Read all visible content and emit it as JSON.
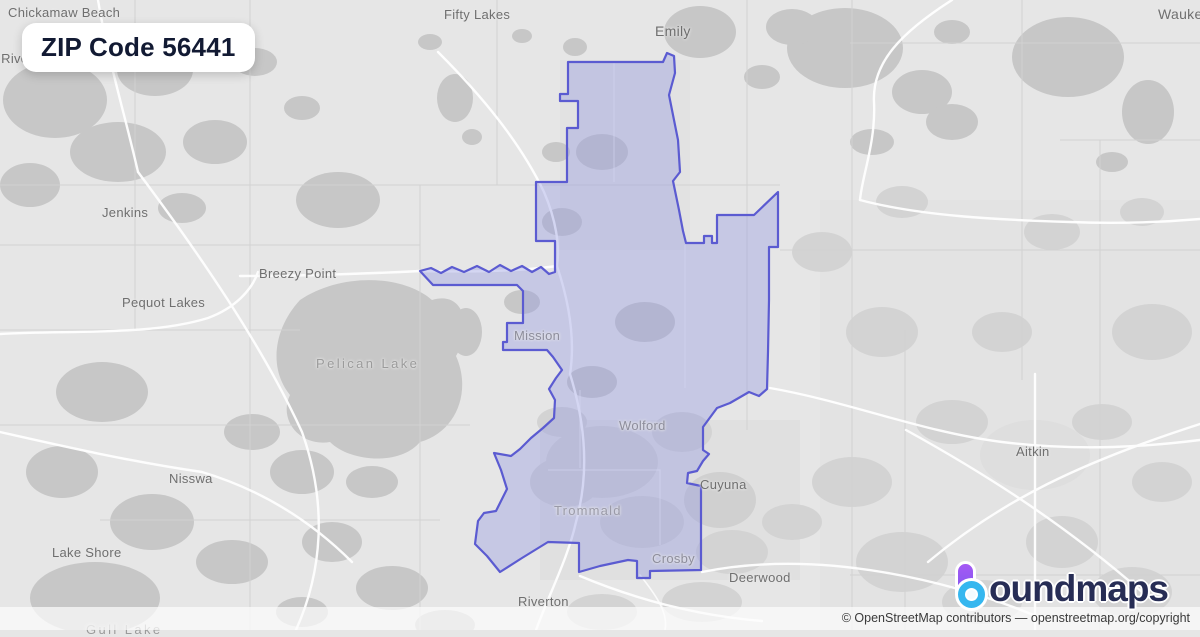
{
  "title": {
    "text": "ZIP Code 56441"
  },
  "map": {
    "region": {
      "name": "ZIP 56441 boundary",
      "fill": "rgba(150,156,226,0.40)",
      "stroke": "#5b5bd1"
    },
    "labels": [
      {
        "text": "Chickamaw Beach"
      },
      {
        "text": "Pine River"
      },
      {
        "text": "Fifty Lakes"
      },
      {
        "text": "Emily"
      },
      {
        "text": "Waukenabo"
      },
      {
        "text": "Jenkins"
      },
      {
        "text": "Breezy Point"
      },
      {
        "text": "Pequot Lakes"
      },
      {
        "text": "Pelican Lake"
      },
      {
        "text": "Nisswa"
      },
      {
        "text": "Lake Shore"
      },
      {
        "text": "Gull Lake"
      },
      {
        "text": "Mission"
      },
      {
        "text": "Wolford"
      },
      {
        "text": "Trommald"
      },
      {
        "text": "Cuyuna"
      },
      {
        "text": "Crosby"
      },
      {
        "text": "Deerwood"
      },
      {
        "text": "Riverton"
      },
      {
        "text": "Aitkin"
      }
    ]
  },
  "logo": {
    "icon": "boundmaps-b-pin-icon",
    "brand_rest": "oundmaps",
    "navy": "#272d55",
    "purple": "#8b5cf6",
    "cyan": "#36b7ef"
  },
  "attribution": {
    "prefix": "© OpenStreetMap contributors — ",
    "link": "openstreetmap.org/copyright"
  }
}
